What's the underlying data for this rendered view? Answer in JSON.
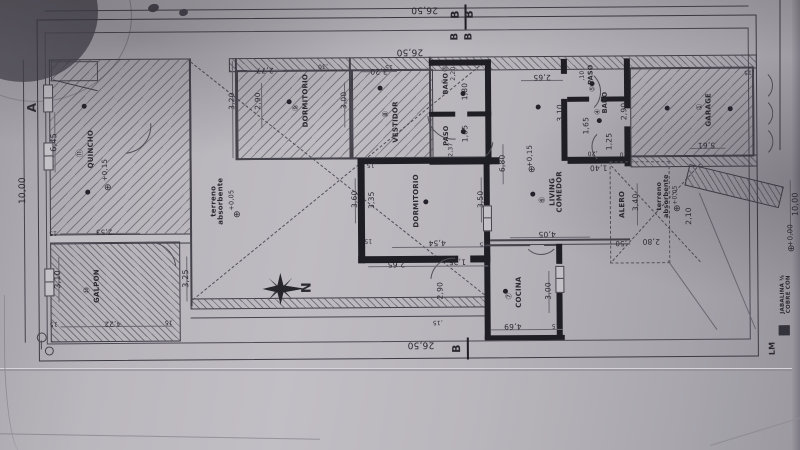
{
  "document": {
    "kind": "architectural floor plan photo",
    "north_label": "N",
    "accent_line_color": "#2b2a31",
    "paper_color": "#b7b4ba"
  },
  "rooms": [
    {
      "number": "①",
      "name": "GARAGE"
    },
    {
      "number": "③",
      "name": "BAÑO"
    },
    {
      "number": "④",
      "name": "BAÑO"
    },
    {
      "number": "⑤",
      "name": "PASO"
    },
    {
      "number": "⑥",
      "name": "LIVING COMEDOR"
    },
    {
      "number": "⑦",
      "name": "COCINA"
    },
    {
      "number": "⑧",
      "name": "VESTIDOR"
    },
    {
      "number": "⑨",
      "name": "DORMITORIO"
    },
    {
      "number": "",
      "name": "DORMITORIO"
    },
    {
      "number": "⑩",
      "name": "GALPON"
    },
    {
      "number": "⑪",
      "name": "QUINCHO"
    }
  ],
  "site": {
    "width_dim": "26,50",
    "depth_dim": "10,00",
    "section_markers": [
      "A",
      "B"
    ]
  },
  "labels": [
    {
      "n": "dim-site-top-outer",
      "t": "26,50",
      "x": 426,
      "y": 9,
      "r": 180,
      "s": 9
    },
    {
      "n": "section-b-marker",
      "t": "B",
      "x": 457,
      "y": 15,
      "r": -90,
      "s": 11,
      "b": 1
    },
    {
      "n": "section-b-marker",
      "t": "B",
      "x": 471,
      "y": 15,
      "r": -90,
      "s": 11,
      "b": 1
    },
    {
      "n": "section-b-marker",
      "t": "B",
      "x": 457,
      "y": 37,
      "r": -90,
      "s": 10,
      "b": 1
    },
    {
      "n": "section-b-marker",
      "t": "B",
      "x": 471,
      "y": 37,
      "r": -90,
      "s": 10,
      "b": 1
    },
    {
      "n": "dim-site-top-inner",
      "t": "26,50",
      "x": 411,
      "y": 51,
      "r": 180,
      "s": 9
    },
    {
      "n": "dim-site-bottom",
      "t": "26,50",
      "x": 420,
      "y": 344,
      "r": 180,
      "s": 9
    },
    {
      "n": "section-b-marker",
      "t": "B",
      "x": 456,
      "y": 349,
      "r": -90,
      "s": 11,
      "b": 1
    },
    {
      "n": "section-a-marker",
      "t": "A",
      "x": 33,
      "y": 105,
      "r": -90,
      "s": 12,
      "b": 1
    },
    {
      "n": "dim-site-left",
      "t": "10,00",
      "x": 24,
      "y": 188,
      "r": -90,
      "s": 9
    },
    {
      "n": "dim-quincho",
      "t": "6,45",
      "x": 55,
      "y": 140,
      "r": -90,
      "s": 8
    },
    {
      "n": "room-number-quincho",
      "t": "⑪",
      "x": 81,
      "y": 151,
      "r": -90,
      "s": 8
    },
    {
      "n": "room-label-quincho",
      "t": "QUINCHO",
      "x": 92,
      "y": 147,
      "r": -90,
      "s": 7,
      "b": 1
    },
    {
      "n": "level-quincho",
      "t": "+0,15",
      "x": 106,
      "y": 168,
      "r": -90,
      "s": 7
    },
    {
      "n": "dim-quincho-b",
      "t": "2,53",
      "x": 104,
      "y": 229,
      "r": 180,
      "s": 7
    },
    {
      "n": "dim-wall",
      "t": "15",
      "x": 53,
      "y": 230,
      "r": 180,
      "s": 6
    },
    {
      "n": "dim-galpon",
      "t": "3,10",
      "x": 58,
      "y": 277,
      "r": -90,
      "s": 8
    },
    {
      "n": "room-number-galpon",
      "t": "⑩",
      "x": 87,
      "y": 288,
      "r": -90,
      "s": 8
    },
    {
      "n": "room-label-galpon",
      "t": "GALPON",
      "x": 97,
      "y": 284,
      "r": -90,
      "s": 7,
      "b": 1
    },
    {
      "n": "dim-galpon-b",
      "t": "4,22",
      "x": 112,
      "y": 321,
      "r": 180,
      "s": 7
    },
    {
      "n": "dim-wall",
      "t": "15",
      "x": 53,
      "y": 321,
      "r": 180,
      "s": 6
    },
    {
      "n": "dim-wall",
      "t": "15",
      "x": 168,
      "y": 320,
      "r": 180,
      "s": 6
    },
    {
      "n": "dim-patio-left",
      "t": "3,25",
      "x": 186,
      "y": 277,
      "r": -90,
      "s": 8
    },
    {
      "n": "note-terreno-1",
      "t": "terreno\nabsorbente",
      "x": 218,
      "y": 200,
      "r": -90,
      "s": 7,
      "b": 1
    },
    {
      "n": "level-terreno-1",
      "t": "+0,05",
      "x": 232,
      "y": 199,
      "r": -90,
      "s": 6.5
    },
    {
      "n": "compass-label",
      "t": "N",
      "x": 307,
      "y": 287,
      "r": -90,
      "s": 13,
      "b": 1
    },
    {
      "n": "dim-dorm9-top",
      "t": "2,77",
      "x": 266,
      "y": 69,
      "r": 180,
      "s": 7.5
    },
    {
      "n": "dim-dorm9-left",
      "t": "2,90",
      "x": 259,
      "y": 100,
      "r": -90,
      "s": 7.5
    },
    {
      "n": "dim-patio-top",
      "t": "3,20",
      "x": 233,
      "y": 100,
      "r": -90,
      "s": 7.5
    },
    {
      "n": "dim-wall",
      "t": ",30",
      "x": 324,
      "y": 65,
      "r": 180,
      "s": 6
    },
    {
      "n": "dim-wall",
      "t": "15",
      "x": 390,
      "y": 66,
      "r": 180,
      "s": 6
    },
    {
      "n": "room-number-dorm9",
      "t": "⑨",
      "x": 297,
      "y": 107,
      "r": -90,
      "s": 8
    },
    {
      "n": "room-label-dorm9",
      "t": "DORMITORIO",
      "x": 307,
      "y": 100,
      "r": -90,
      "s": 7,
      "b": 1
    },
    {
      "n": "dim-dorm9-right",
      "t": "3,00",
      "x": 345,
      "y": 100,
      "r": -90,
      "s": 7.5
    },
    {
      "n": "dim-vestidor-top",
      "t": "3,20",
      "x": 380,
      "y": 71,
      "r": 180,
      "s": 7.5
    },
    {
      "n": "room-number-vestidor",
      "t": "⑧",
      "x": 387,
      "y": 114,
      "r": -90,
      "s": 8
    },
    {
      "n": "room-label-vestidor",
      "t": "VESTIDOR",
      "x": 397,
      "y": 122,
      "r": -90,
      "s": 7,
      "b": 1
    },
    {
      "n": "room-number-bano3",
      "t": "③",
      "x": 447,
      "y": 69,
      "r": -90,
      "s": 7
    },
    {
      "n": "room-label-bano3",
      "t": "BAÑO",
      "x": 447,
      "y": 84,
      "r": -90,
      "s": 6.5,
      "b": 1
    },
    {
      "n": "dim-bano3-top",
      "t": "2,20",
      "x": 455,
      "y": 74,
      "r": -90,
      "s": 6
    },
    {
      "n": "dim-bano3",
      "t": "1,80",
      "x": 466,
      "y": 92,
      "r": -90,
      "s": 7.5
    },
    {
      "n": "room-label-paso2",
      "t": "PASO",
      "x": 447,
      "y": 136,
      "r": -90,
      "s": 6.5,
      "b": 1
    },
    {
      "n": "dim-paso2",
      "t": "1,05",
      "x": 466,
      "y": 134,
      "r": -90,
      "s": 7.5
    },
    {
      "n": "dim-paso2-b",
      "t": "2,37",
      "x": 452,
      "y": 150,
      "r": -90,
      "s": 6
    },
    {
      "n": "dim-dorm-left-a",
      "t": "3,60",
      "x": 355,
      "y": 199,
      "r": -90,
      "s": 7.5
    },
    {
      "n": "dim-dorm-left-b",
      "t": "3,35",
      "x": 372,
      "y": 200,
      "r": -90,
      "s": 7.5
    },
    {
      "n": "room-label-dorm-main",
      "t": "DORMITORIO",
      "x": 417,
      "y": 201,
      "r": -90,
      "s": 7,
      "b": 1
    },
    {
      "n": "dim-dorm-right",
      "t": "3,50",
      "x": 481,
      "y": 200,
      "r": -90,
      "s": 7.5
    },
    {
      "n": "dim-dorm-bottom",
      "t": "4,54",
      "x": 437,
      "y": 243,
      "r": 180,
      "s": 7.5
    },
    {
      "n": "dim-wall",
      "t": ",15",
      "x": 372,
      "y": 164,
      "r": 180,
      "s": 6
    },
    {
      "n": "dim-wall",
      "t": "15",
      "x": 368,
      "y": 240,
      "r": 180,
      "s": 6
    },
    {
      "n": "dim-wall",
      "t": ",15",
      "x": 484,
      "y": 244,
      "r": 180,
      "s": 6
    },
    {
      "n": "dim-below-dorm-a",
      "t": "2,65",
      "x": 396,
      "y": 264,
      "r": 180,
      "s": 7.5
    },
    {
      "n": "dim-below-dorm-b",
      "t": "1,25",
      "x": 457,
      "y": 262,
      "r": 180,
      "s": 7.5
    },
    {
      "n": "dim-passage",
      "t": "2,90",
      "x": 440,
      "y": 291,
      "r": -90,
      "s": 7.5
    },
    {
      "n": "dim-wall",
      "t": ",15",
      "x": 437,
      "y": 322,
      "r": 180,
      "s": 6
    },
    {
      "n": "dim-cocina-bottom",
      "t": "4,69",
      "x": 512,
      "y": 327,
      "r": 180,
      "s": 7.5
    },
    {
      "n": "dim-wall",
      "t": ",15",
      "x": 556,
      "y": 326,
      "r": 180,
      "s": 6
    },
    {
      "n": "room-number-cocina",
      "t": "⑦",
      "x": 509,
      "y": 297,
      "r": -90,
      "s": 8
    },
    {
      "n": "room-label-cocina",
      "t": "COCINA",
      "x": 519,
      "y": 293,
      "r": -90,
      "s": 7,
      "b": 1
    },
    {
      "n": "dim-cocina-right",
      "t": "3,00",
      "x": 548,
      "y": 292,
      "r": -90,
      "s": 7.5
    },
    {
      "n": "dim-living-top",
      "t": "2,65",
      "x": 543,
      "y": 78,
      "r": 180,
      "s": 7.5
    },
    {
      "n": "level-living",
      "t": "+0,15",
      "x": 531,
      "y": 157,
      "r": -90,
      "s": 7
    },
    {
      "n": "dim-living-left",
      "t": "6,80",
      "x": 503,
      "y": 164,
      "r": -90,
      "s": 7.5
    },
    {
      "n": "room-number-living",
      "t": "⑥",
      "x": 543,
      "y": 201,
      "r": -90,
      "s": 8
    },
    {
      "n": "room-label-living",
      "t": "LIVING\nCOMEDOR",
      "x": 557,
      "y": 193,
      "r": -90,
      "s": 7,
      "b": 1
    },
    {
      "n": "dim-living-bottom",
      "t": "4,05",
      "x": 547,
      "y": 235,
      "r": 180,
      "s": 7.5
    },
    {
      "n": "dim-paso5-top",
      "t": ",10",
      "x": 584,
      "y": 77,
      "r": -90,
      "s": 6
    },
    {
      "n": "room-label-paso5",
      "t": "PASO",
      "x": 592,
      "y": 76,
      "r": -90,
      "s": 6.5,
      "b": 1
    },
    {
      "n": "room-number-paso5",
      "t": "⑤",
      "x": 594,
      "y": 90,
      "r": -90,
      "s": 7
    },
    {
      "n": "dim-paso5-left",
      "t": "3,10",
      "x": 561,
      "y": 114,
      "r": -90,
      "s": 7.5
    },
    {
      "n": "room-number-bano4",
      "t": "④",
      "x": 599,
      "y": 113,
      "r": -90,
      "s": 7
    },
    {
      "n": "room-label-bano4",
      "t": "BAÑO",
      "x": 606,
      "y": 104,
      "r": -90,
      "s": 6.5,
      "b": 1
    },
    {
      "n": "dim-bano4-a",
      "t": "1,65",
      "x": 587,
      "y": 127,
      "r": -90,
      "s": 7.5
    },
    {
      "n": "dim-bano4-b",
      "t": "1,25",
      "x": 610,
      "y": 143,
      "r": -90,
      "s": 7.5
    },
    {
      "n": "dim-garage-left",
      "t": "2,90",
      "x": 625,
      "y": 113,
      "r": -90,
      "s": 7.5
    },
    {
      "n": "dim-entry-a",
      "t": "1,40",
      "x": 599,
      "y": 169,
      "r": 180,
      "s": 7.5
    },
    {
      "n": "dim-wall",
      "t": ",20",
      "x": 593,
      "y": 154,
      "r": 180,
      "s": 6
    },
    {
      "n": "dim-wall",
      "t": ",20",
      "x": 625,
      "y": 155,
      "r": 180,
      "s": 6
    },
    {
      "n": "room-number-garage",
      "t": "①",
      "x": 701,
      "y": 109,
      "r": -90,
      "s": 8
    },
    {
      "n": "room-label-garage",
      "t": "GARAGE",
      "x": 710,
      "y": 112,
      "r": -90,
      "s": 7,
      "b": 1
    },
    {
      "n": "dim-garage",
      "t": "5,61",
      "x": 707,
      "y": 147,
      "r": 180,
      "s": 7.5
    },
    {
      "n": "dim-wall",
      "t": ",15",
      "x": 750,
      "y": 74,
      "r": 180,
      "s": 6
    },
    {
      "n": "room-label-alero",
      "t": "ALERO",
      "x": 623,
      "y": 206,
      "r": -90,
      "s": 7,
      "b": 1
    },
    {
      "n": "dim-alero",
      "t": "3,40",
      "x": 636,
      "y": 204,
      "r": -90,
      "s": 7.5
    },
    {
      "n": "dim-alero-b",
      "t": "2,10",
      "x": 689,
      "y": 218,
      "r": -90,
      "s": 7.5
    },
    {
      "n": "note-terreno-2",
      "t": "terreno\nabsorbente",
      "x": 663,
      "y": 198,
      "r": -90,
      "s": 6.5,
      "b": 1
    },
    {
      "n": "level-terreno-2",
      "t": "+0,05",
      "x": 676,
      "y": 197,
      "r": -90,
      "s": 6
    },
    {
      "n": "dim-entry-b",
      "t": ",50",
      "x": 621,
      "y": 244,
      "r": 180,
      "s": 7
    },
    {
      "n": "dim-entry-c",
      "t": "2,80",
      "x": 651,
      "y": 243,
      "r": 180,
      "s": 7.5
    },
    {
      "n": "level-entry",
      "t": "+0,00",
      "x": 791,
      "y": 238,
      "r": -90,
      "s": 7
    },
    {
      "n": "dim-site-right",
      "t": "10,00",
      "x": 796,
      "y": 207,
      "r": -90,
      "s": 8
    },
    {
      "n": "note-jabalina",
      "t": "JABALINA ⅛\nCOBRE CON",
      "x": 786,
      "y": 297,
      "r": -90,
      "s": 5.5,
      "b": 1
    },
    {
      "n": "marker-lm",
      "t": "LM",
      "x": 772,
      "y": 351,
      "r": -90,
      "s": 8,
      "b": 1
    }
  ],
  "light_dots": [
    [
      85,
      104
    ],
    [
      88,
      190
    ],
    [
      290,
      101
    ],
    [
      381,
      88
    ],
    [
      464,
      94
    ],
    [
      464,
      132
    ],
    [
      426,
      202
    ],
    [
      539,
      108
    ],
    [
      533,
      195
    ],
    [
      593,
      85
    ],
    [
      600,
      122
    ],
    [
      505,
      292
    ],
    [
      668,
      110
    ],
    [
      731,
      111
    ]
  ],
  "level_marks": [
    [
      108,
      186
    ],
    [
      237,
      214
    ],
    [
      532,
      171
    ],
    [
      677,
      211
    ],
    [
      791,
      252
    ]
  ],
  "level_symbol": "⊕"
}
